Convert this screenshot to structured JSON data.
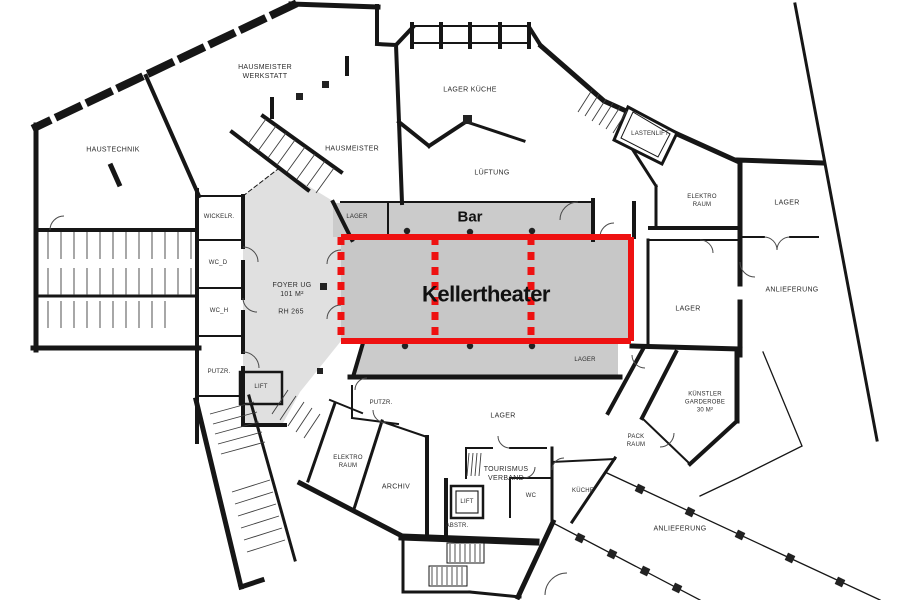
{
  "colors": {
    "highlight_red": "#ee1111",
    "theater_fill": "#c7c7c7",
    "zone_fill": "#cbcbcb",
    "foyer_fill": "#e0e0e0",
    "wall": "#161616"
  },
  "highlight": {
    "label": "Kellertheater"
  },
  "bar": {
    "label": "Bar"
  },
  "rooms": {
    "hausmeister_werkstatt": {
      "label": "HAUSMEISTER\nWERKSTATT"
    },
    "haustechnik": {
      "label": "HAUSTECHNIK"
    },
    "hausmeister": {
      "label": "HAUSMEISTER"
    },
    "lager_kueche": {
      "label": "LAGER KÜCHE"
    },
    "lueftung": {
      "label": "LÜFTUNG"
    },
    "lastenlift": {
      "label": "LASTENLIFT"
    },
    "elektro_raum_ne": {
      "label": "ELEKTRO\nRAUM"
    },
    "lager_ne": {
      "label": "LAGER"
    },
    "anlieferung_e": {
      "label": "ANLIEFERUNG"
    },
    "lager_e": {
      "label": "LAGER"
    },
    "wickelr": {
      "label": "WICKELR."
    },
    "wc_d": {
      "label": "WC_D"
    },
    "wc_h": {
      "label": "WC_H"
    },
    "putzr_w": {
      "label": "PUTZR."
    },
    "lift_w": {
      "label": "LIFT"
    },
    "foyer": {
      "label": "FOYER UG\n101 M²"
    },
    "foyer_rh": {
      "label": "RH 265"
    },
    "lager_bar": {
      "label": "LAGER"
    },
    "lager_stage": {
      "label": "LAGER"
    },
    "putzr_s": {
      "label": "PUTZR."
    },
    "lager_s": {
      "label": "LAGER"
    },
    "elektro_raum_sw": {
      "label": "ELEKTRO\nRAUM"
    },
    "archiv": {
      "label": "ARCHIV"
    },
    "tourismus": {
      "label": "TOURISMUS\nVERBAND"
    },
    "lift_s": {
      "label": "LIFT"
    },
    "wc_s": {
      "label": "WC"
    },
    "kueche": {
      "label": "KÜCHE"
    },
    "abstr": {
      "label": "ABSTR."
    },
    "kuenstler": {
      "label": "KÜNSTLER\nGARDEROBE\n30 M²"
    },
    "pack_raum": {
      "label": "PACK\nRAUM"
    },
    "anlieferung_s": {
      "label": "ANLIEFERUNG"
    }
  }
}
